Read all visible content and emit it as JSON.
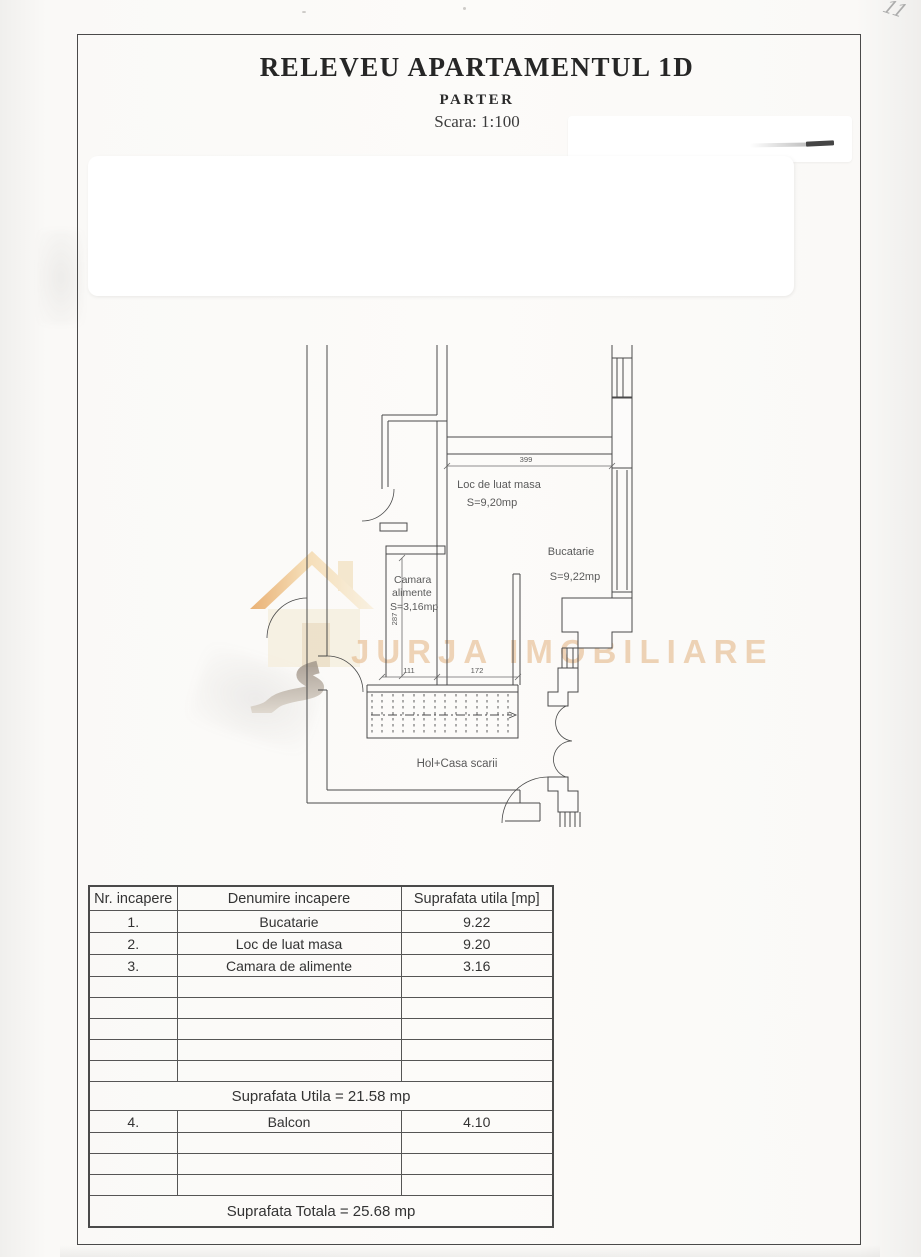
{
  "page": {
    "title": "RELEVEU APARTAMENTUL 1D",
    "subtitle": "PARTER",
    "scale_label": "Scara: 1:100",
    "handwritten_mark": "11"
  },
  "watermark": {
    "text": "JURJA IMOBILIARE",
    "brand_color": "#e3b380"
  },
  "plan": {
    "labels": {
      "dining_room": "Loc de luat masa",
      "dining_area": "S=9,20mp",
      "kitchen": "Bucatarie",
      "kitchen_area": "S=9,22mp",
      "pantry_line1": "Camara",
      "pantry_line2": "alimente",
      "pantry_area": "S=3,16mp",
      "hall": "Hol+Casa scarii"
    },
    "dimensions": {
      "top_width": "399",
      "pantry_height": "287",
      "pantry_width": "111",
      "hall_width": "172"
    }
  },
  "table": {
    "headers": [
      "Nr. incapere",
      "Denumire incapere",
      "Suprafata utila [mp]"
    ],
    "rows": [
      {
        "nr": "1.",
        "name": "Bucatarie",
        "area": "9.22"
      },
      {
        "nr": "2.",
        "name": "Loc de luat masa",
        "area": "9.20"
      },
      {
        "nr": "3.",
        "name": "Camara de alimente",
        "area": "3.16"
      }
    ],
    "empty_rows_mid": 5,
    "useful_area_total": "Suprafata Utila = 21.58 mp",
    "balcony_row": {
      "nr": "4.",
      "name": "Balcon",
      "area": "4.10"
    },
    "empty_rows_bottom": 3,
    "grand_total": "Suprafata Totala = 25.68 mp"
  }
}
